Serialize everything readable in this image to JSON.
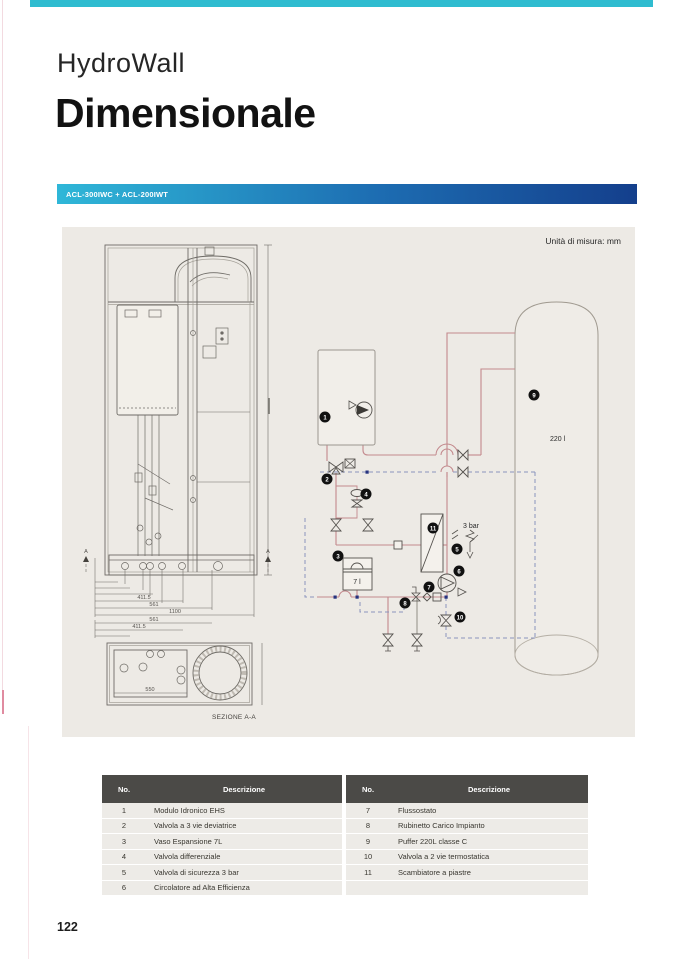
{
  "header": {
    "product": "HydroWall",
    "title": "Dimensionale",
    "model_bar": "ACL-300IWC + ACL-200IWT"
  },
  "panel": {
    "units_note": "Unità di misura: mm",
    "drawing": {
      "section_label": "SEZIONE A-A",
      "cut_marker": "A",
      "dims": {
        "d411": "411.5",
        "d561": "561",
        "d1100": "1100",
        "d550": "550"
      }
    },
    "schematic": {
      "vessel_volume": "7 l",
      "tank_volume": "220 l",
      "pressure_label": "3 bar",
      "badges": {
        "b1": "1",
        "b2": "2",
        "b3": "3",
        "b4": "4",
        "b5": "5",
        "b6": "6",
        "b7": "7",
        "b8": "8",
        "b9": "9",
        "b10": "10",
        "b11": "11"
      }
    }
  },
  "tables": {
    "col_no": "No.",
    "col_desc": "Descrizione",
    "left_rows": [
      {
        "no": "1",
        "desc": "Modulo Idronico EHS"
      },
      {
        "no": "2",
        "desc": "Valvola a 3 vie deviatrice"
      },
      {
        "no": "3",
        "desc": "Vaso Espansione 7L"
      },
      {
        "no": "4",
        "desc": "Valvola differenziale"
      },
      {
        "no": "5",
        "desc": "Valvola di sicurezza 3 bar"
      },
      {
        "no": "6",
        "desc": "Circolatore ad Alta Efficienza"
      }
    ],
    "right_rows": [
      {
        "no": "7",
        "desc": "Flussostato"
      },
      {
        "no": "8",
        "desc": "Rubinetto Carico Impianto"
      },
      {
        "no": "9",
        "desc": "Puffer 220L classe C"
      },
      {
        "no": "10",
        "desc": "Valvola a 2 vie termostatica"
      },
      {
        "no": "11",
        "desc": "Scambiatore a piastre"
      },
      {
        "no": "",
        "desc": ""
      }
    ]
  },
  "page": {
    "number": "122"
  },
  "colors": {
    "accent_cyan": "#2fbcd0",
    "gradient_start": "#2fb7d8",
    "gradient_end": "#143f8c",
    "panel_bg": "#edeae5",
    "table_header_bg": "#4b4a47",
    "pipe_heating": "#c3898d",
    "pipe_dhw_dashed": "#8a94bd"
  }
}
